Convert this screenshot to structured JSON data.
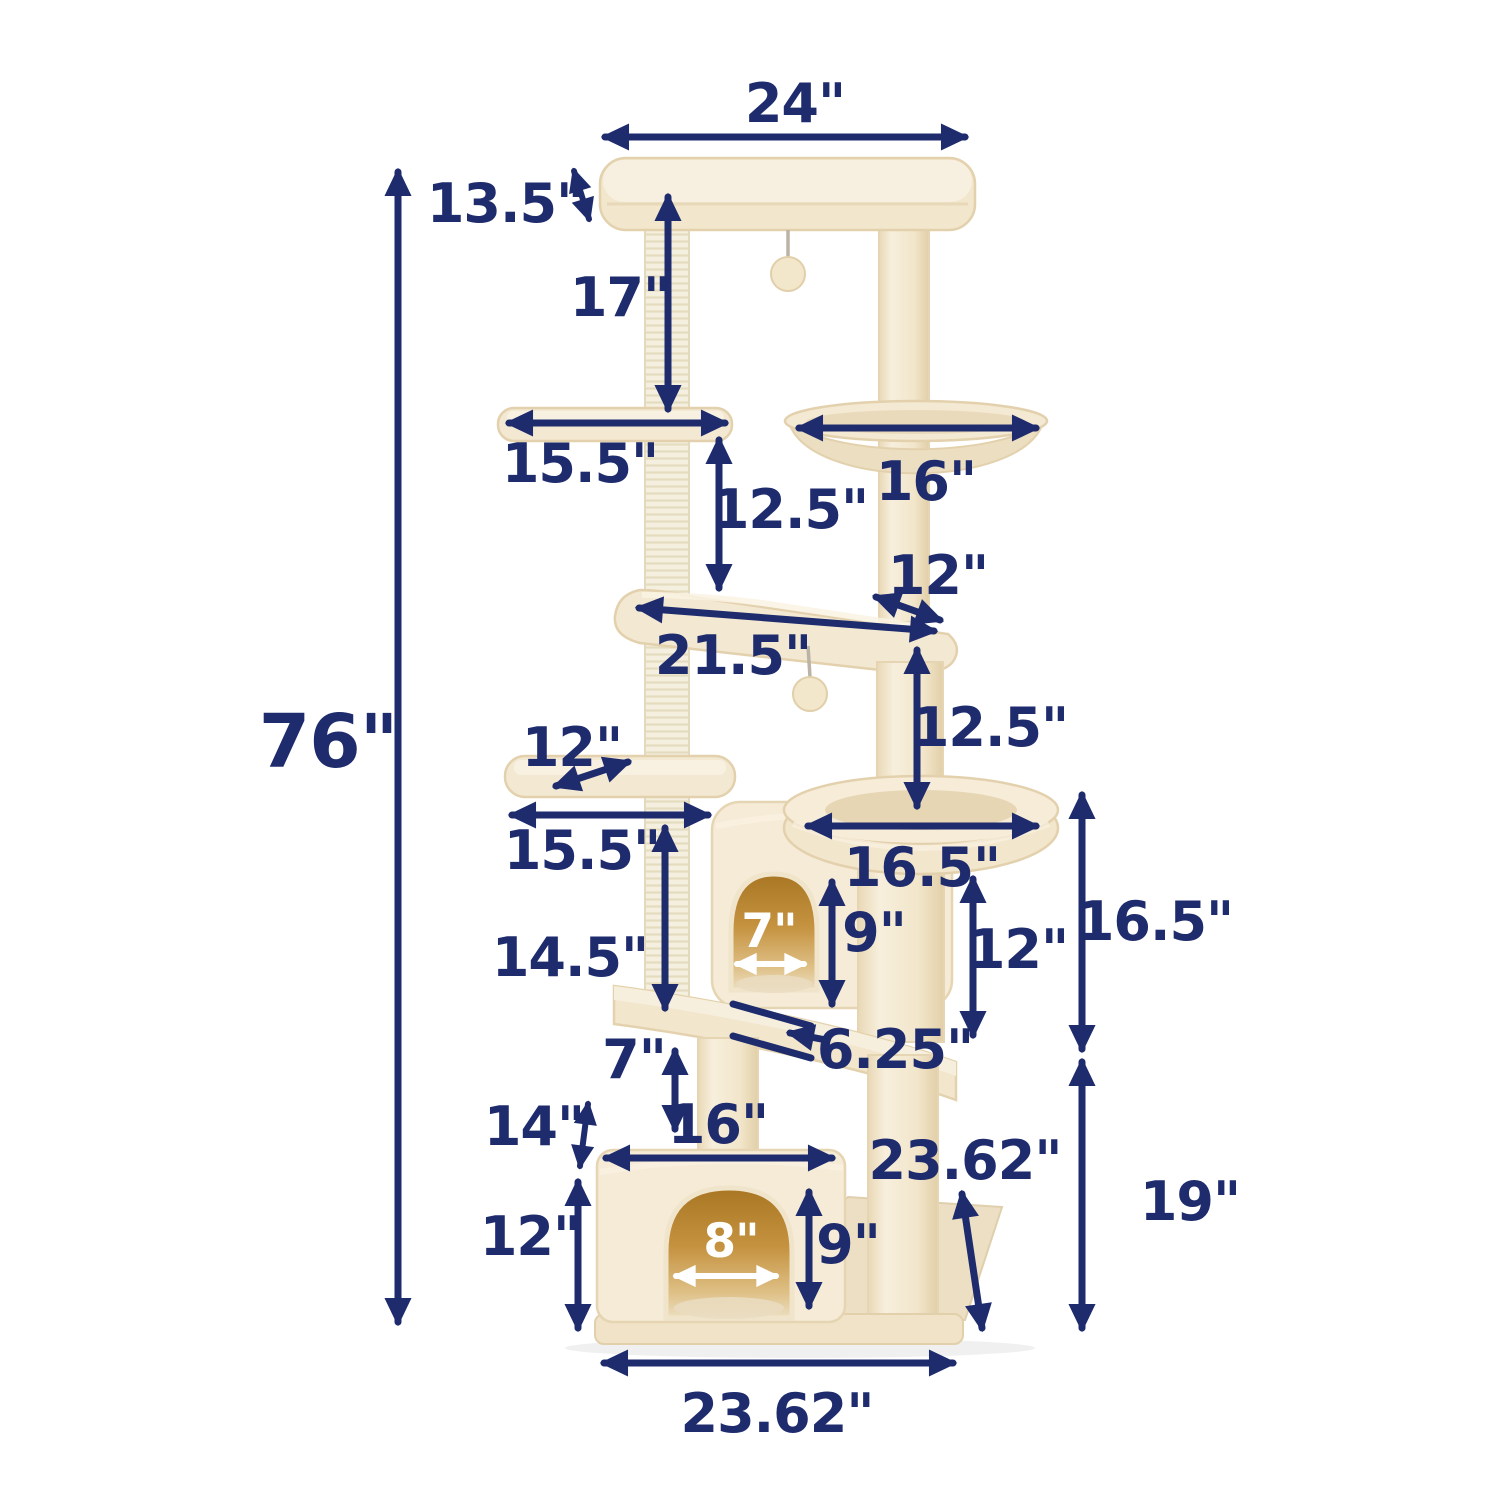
{
  "diagram": {
    "subject": "cat-tree-dimension-diagram",
    "unit": "inches",
    "colors": {
      "annotation_navy": "#1e2b6d",
      "white_arrow": "#ffffff",
      "plush_cream": "#f3e8d1",
      "plush_edge": "#e3d1ad",
      "sisal": "#f4efdf",
      "door_amber": "#c5923f"
    },
    "dims": {
      "total_height": "76\"",
      "top_width": "24\"",
      "top_depth": "13.5\"",
      "top_to_upper_perch": "17\"",
      "upper_perch_width": "15.5\"",
      "hammock_width": "16\"",
      "upper_perch_to_platform": "12.5\"",
      "platform_corner_depth": "12\"",
      "platform_width": "21.5\"",
      "platform_to_bed": "12.5\"",
      "small_perch_width": "12\"",
      "small_perch_level_width": "15.5\"",
      "bed_width": "16.5\"",
      "condo_level_height": "14.5\"",
      "condo_door_width": "7\"",
      "condo_door_height": "9\"",
      "bed_pedestal_height": "12\"",
      "bed_section_height": "16.5\"",
      "ledge_thickness": "6.25\"",
      "ledge_to_house": "7\"",
      "house_depth": "14\"",
      "house_top_width": "16\"",
      "base_depth": "23.62\"",
      "house_height": "12\"",
      "house_door_width": "8\"",
      "house_door_height": "9\"",
      "base_section_height": "19\"",
      "base_width": "23.62\""
    }
  }
}
